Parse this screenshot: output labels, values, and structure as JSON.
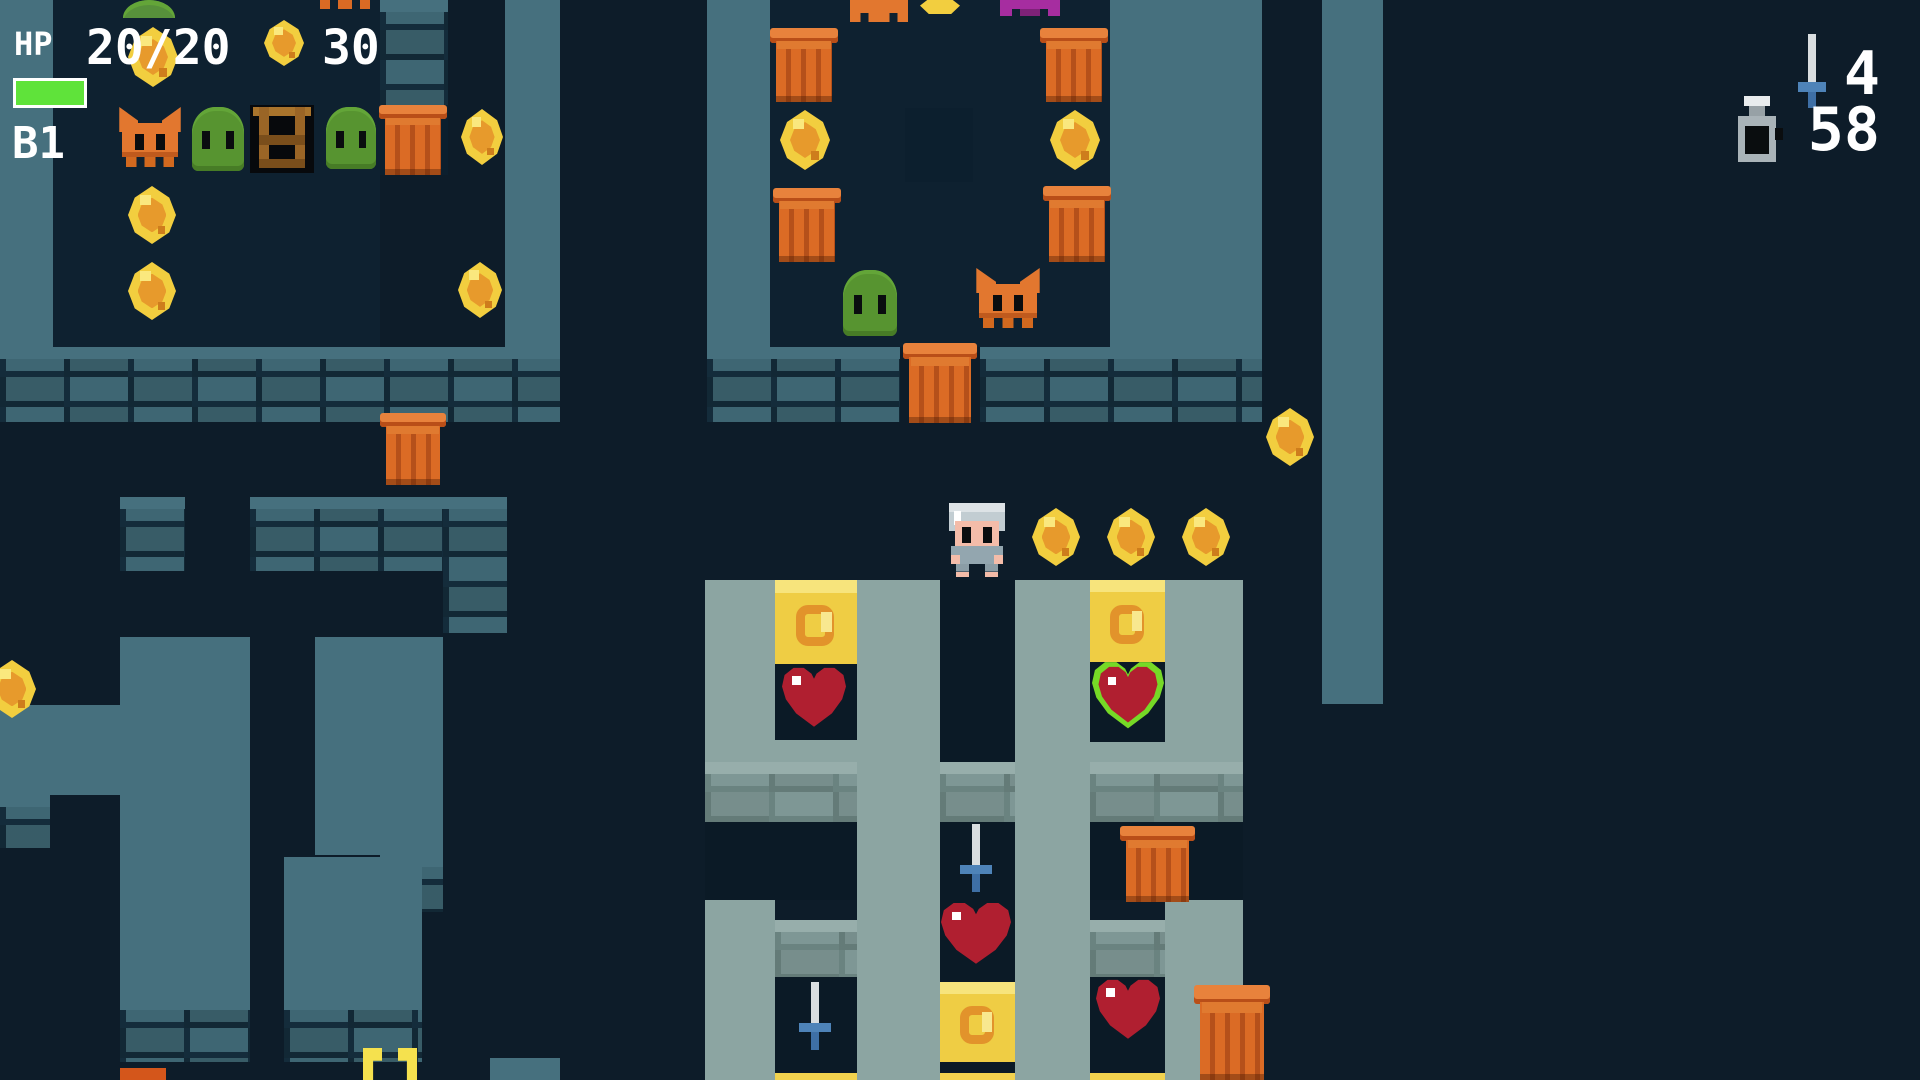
{
  "hud": {
    "hp_label": "HP",
    "hp_value": "20/20",
    "hp_percent": 100,
    "coin_count": "30",
    "floor": "B1",
    "sword_count": "4",
    "flask_count": "58",
    "icons": [
      "coin-icon",
      "sword-icon",
      "flask-icon"
    ]
  },
  "colors": {
    "background": "#0D1C29",
    "wall_teal": "#46707E",
    "wall_sage": "#8CA5A2",
    "hp_green": "#5FE33A",
    "coin_yellow": "#F2CE3F",
    "barrel_orange": "#DB6B25",
    "slime_green": "#579430",
    "bat_orange": "#E2772F",
    "heart_red": "#B01F30",
    "heart_ring_green": "#76D926",
    "sword_blue": "#4E83B8",
    "text": "#FFFFFF"
  },
  "map": {
    "walls": [
      {
        "x": 0,
        "y": 0,
        "w": 53,
        "h": 347,
        "s": "teal"
      },
      {
        "x": 380,
        "y": 0,
        "w": 68,
        "h": 105,
        "s": "tealb"
      },
      {
        "x": 505,
        "y": 0,
        "w": 55,
        "h": 347,
        "s": "teal"
      },
      {
        "x": 0,
        "y": 347,
        "w": 560,
        "h": 75,
        "s": "tealb"
      },
      {
        "x": 120,
        "y": 497,
        "w": 65,
        "h": 74,
        "s": "tealb"
      },
      {
        "x": 250,
        "y": 497,
        "w": 193,
        "h": 74,
        "s": "tealb"
      },
      {
        "x": 443,
        "y": 497,
        "w": 64,
        "h": 136,
        "s": "tealb"
      },
      {
        "x": 120,
        "y": 637,
        "w": 130,
        "h": 425,
        "s": "teal"
      },
      {
        "x": 120,
        "y": 998,
        "w": 130,
        "h": 64,
        "s": "tealb"
      },
      {
        "x": 0,
        "y": 705,
        "w": 120,
        "h": 90,
        "s": "teal"
      },
      {
        "x": 0,
        "y": 795,
        "w": 50,
        "h": 53,
        "s": "tealb"
      },
      {
        "x": 315,
        "y": 637,
        "w": 128,
        "h": 218,
        "s": "teal"
      },
      {
        "x": 380,
        "y": 855,
        "w": 63,
        "h": 57,
        "s": "tealb"
      },
      {
        "x": 284,
        "y": 857,
        "w": 138,
        "h": 141,
        "s": "teal"
      },
      {
        "x": 284,
        "y": 998,
        "w": 138,
        "h": 64,
        "s": "tealb"
      },
      {
        "x": 490,
        "y": 1058,
        "w": 70,
        "h": 22,
        "s": "teal"
      },
      {
        "x": 707,
        "y": 0,
        "w": 63,
        "h": 347,
        "s": "teal"
      },
      {
        "x": 1110,
        "y": 0,
        "w": 152,
        "h": 347,
        "s": "teal"
      },
      {
        "x": 707,
        "y": 347,
        "w": 193,
        "h": 75,
        "s": "tealb"
      },
      {
        "x": 980,
        "y": 347,
        "w": 282,
        "h": 75,
        "s": "tealb"
      },
      {
        "x": 840,
        "y": 20,
        "w": 200,
        "h": 182,
        "s": "tealL"
      },
      {
        "x": 840,
        "y": 202,
        "w": 200,
        "h": 61,
        "s": "tealLb"
      },
      {
        "x": 905,
        "y": 42,
        "w": 68,
        "h": 66,
        "s": "navyb"
      },
      {
        "x": 1322,
        "y": 0,
        "w": 61,
        "h": 704,
        "s": "teal"
      },
      {
        "x": 705,
        "y": 580,
        "w": 70,
        "h": 242,
        "s": "sage"
      },
      {
        "x": 705,
        "y": 900,
        "w": 70,
        "h": 180,
        "s": "sage"
      },
      {
        "x": 857,
        "y": 580,
        "w": 83,
        "h": 500,
        "s": "sage"
      },
      {
        "x": 1015,
        "y": 580,
        "w": 75,
        "h": 500,
        "s": "sage"
      },
      {
        "x": 1165,
        "y": 580,
        "w": 78,
        "h": 242,
        "s": "sage"
      },
      {
        "x": 1165,
        "y": 900,
        "w": 78,
        "h": 180,
        "s": "sage"
      },
      {
        "x": 775,
        "y": 740,
        "w": 82,
        "h": 22,
        "s": "sage"
      },
      {
        "x": 1090,
        "y": 742,
        "w": 75,
        "h": 20,
        "s": "sage"
      },
      {
        "x": 705,
        "y": 762,
        "w": 152,
        "h": 60,
        "s": "sageb"
      },
      {
        "x": 940,
        "y": 762,
        "w": 75,
        "h": 60,
        "s": "sageb"
      },
      {
        "x": 1090,
        "y": 762,
        "w": 153,
        "h": 60,
        "s": "sageb"
      },
      {
        "x": 775,
        "y": 920,
        "w": 82,
        "h": 57,
        "s": "sageb"
      },
      {
        "x": 1090,
        "y": 920,
        "w": 75,
        "h": 57,
        "s": "sageb"
      }
    ],
    "cells": [
      {
        "x": 53,
        "y": 0,
        "w": 327,
        "h": 347,
        "c": "#0E2130"
      },
      {
        "x": 770,
        "y": 0,
        "w": 340,
        "h": 347,
        "c": "#0E2130"
      },
      {
        "x": 905,
        "y": 108,
        "w": 68,
        "h": 74,
        "c": "#0C1F2E"
      },
      {
        "x": 380,
        "y": 105,
        "w": 68,
        "h": 70,
        "c": "#0C1F2E"
      },
      {
        "x": 775,
        "y": 662,
        "w": 82,
        "h": 78,
        "c": "#0B1A26"
      },
      {
        "x": 775,
        "y": 977,
        "w": 82,
        "h": 96,
        "c": "#0B1A26"
      },
      {
        "x": 940,
        "y": 580,
        "w": 75,
        "h": 182,
        "c": "#0B1A26"
      },
      {
        "x": 940,
        "y": 822,
        "w": 75,
        "h": 160,
        "c": "#0B1A26"
      },
      {
        "x": 940,
        "y": 1062,
        "w": 75,
        "h": 11,
        "c": "#0B1A26"
      },
      {
        "x": 1090,
        "y": 660,
        "w": 75,
        "h": 82,
        "c": "#0B1A26"
      },
      {
        "x": 1090,
        "y": 977,
        "w": 75,
        "h": 96,
        "c": "#0B1A26"
      },
      {
        "x": 705,
        "y": 822,
        "w": 152,
        "h": 78,
        "c": "#0B1A26"
      },
      {
        "x": 1090,
        "y": 822,
        "w": 153,
        "h": 78,
        "c": "#0B1A26"
      }
    ],
    "sprites": [
      {
        "t": "ytile",
        "x": 775,
        "y": 580,
        "w": 82,
        "h": 84
      },
      {
        "t": "ytile",
        "x": 1090,
        "y": 580,
        "w": 75,
        "h": 82
      },
      {
        "t": "ytile",
        "x": 940,
        "y": 982,
        "w": 75,
        "h": 80
      },
      {
        "t": "ysl",
        "x": 775,
        "y": 1073,
        "w": 82,
        "h": 10
      },
      {
        "t": "ysl",
        "x": 940,
        "y": 1073,
        "w": 75,
        "h": 10
      },
      {
        "t": "ysl",
        "x": 1090,
        "y": 1073,
        "w": 75,
        "h": 10
      },
      {
        "t": "coin",
        "x": 128,
        "y": 27,
        "w": 50,
        "h": 60
      },
      {
        "t": "coin",
        "x": 128,
        "y": 186,
        "w": 48,
        "h": 58
      },
      {
        "t": "coin",
        "x": 128,
        "y": 262,
        "w": 48,
        "h": 58
      },
      {
        "t": "coin",
        "x": 458,
        "y": 262,
        "w": 44,
        "h": 56
      },
      {
        "t": "coin",
        "x": 461,
        "y": 109,
        "w": 42,
        "h": 56
      },
      {
        "t": "coin",
        "x": 780,
        "y": 110,
        "w": 50,
        "h": 60
      },
      {
        "t": "coin",
        "x": 1050,
        "y": 110,
        "w": 50,
        "h": 60
      },
      {
        "t": "coin",
        "x": 1032,
        "y": 508,
        "w": 48,
        "h": 58
      },
      {
        "t": "coin",
        "x": 1107,
        "y": 508,
        "w": 48,
        "h": 58
      },
      {
        "t": "coin",
        "x": 1182,
        "y": 508,
        "w": 48,
        "h": 58
      },
      {
        "t": "coin",
        "x": 1266,
        "y": 408,
        "w": 48,
        "h": 58
      },
      {
        "t": "coin",
        "x": -12,
        "y": 660,
        "w": 48,
        "h": 58
      },
      {
        "t": "slime",
        "x": 192,
        "y": 107,
        "w": 52,
        "h": 64
      },
      {
        "t": "slime",
        "x": 326,
        "y": 107,
        "w": 50,
        "h": 62
      },
      {
        "t": "slime",
        "x": 843,
        "y": 270,
        "w": 54,
        "h": 66
      },
      {
        "t": "bat",
        "x": 118,
        "y": 107,
        "w": 64,
        "h": 60
      },
      {
        "t": "bat",
        "x": 975,
        "y": 268,
        "w": 66,
        "h": 60
      },
      {
        "t": "ladder",
        "x": 250,
        "y": 105,
        "w": 64,
        "h": 68
      },
      {
        "t": "barrel",
        "x": 381,
        "y": 105,
        "w": 64,
        "h": 70
      },
      {
        "t": "barrel",
        "x": 382,
        "y": 413,
        "w": 62,
        "h": 72
      },
      {
        "t": "barrel",
        "x": 772,
        "y": 28,
        "w": 64,
        "h": 74
      },
      {
        "t": "barrel",
        "x": 1042,
        "y": 28,
        "w": 64,
        "h": 74
      },
      {
        "t": "barrel",
        "x": 775,
        "y": 188,
        "w": 64,
        "h": 74
      },
      {
        "t": "barrel",
        "x": 1045,
        "y": 186,
        "w": 64,
        "h": 76
      },
      {
        "t": "barrel",
        "x": 905,
        "y": 343,
        "w": 70,
        "h": 80
      },
      {
        "t": "barrel",
        "x": 1122,
        "y": 826,
        "w": 71,
        "h": 76
      },
      {
        "t": "barrel",
        "x": 1196,
        "y": 985,
        "w": 72,
        "h": 95
      },
      {
        "t": "heart",
        "x": 782,
        "y": 666,
        "w": 64,
        "h": 64
      },
      {
        "t": "heart",
        "x": 941,
        "y": 901,
        "w": 70,
        "h": 66
      },
      {
        "t": "heart",
        "x": 1096,
        "y": 978,
        "w": 64,
        "h": 64
      },
      {
        "t": "heartg",
        "x": 1092,
        "y": 660,
        "w": 72,
        "h": 72
      },
      {
        "t": "sword",
        "x": 958,
        "y": 824,
        "w": 36,
        "h": 68
      },
      {
        "t": "sword",
        "x": 797,
        "y": 982,
        "w": 36,
        "h": 68
      },
      {
        "t": "player",
        "x": 945,
        "y": 503,
        "w": 64,
        "h": 74
      },
      {
        "t": "arc",
        "x": 123,
        "y": 0,
        "w": 52,
        "h": 18
      },
      {
        "t": "oslv",
        "x": 320,
        "y": 0,
        "w": 50,
        "h": 9
      },
      {
        "t": "batslv",
        "x": 850,
        "y": 0,
        "w": 58,
        "h": 22
      },
      {
        "t": "coinslv",
        "x": 920,
        "y": 0,
        "w": 40,
        "h": 14
      },
      {
        "t": "pslv",
        "x": 1000,
        "y": 0,
        "w": 60,
        "h": 16
      },
      {
        "t": "prongs",
        "x": 363,
        "y": 1048,
        "w": 54,
        "h": 32
      },
      {
        "t": "oslv2",
        "x": 120,
        "y": 1068,
        "w": 46,
        "h": 12
      }
    ]
  }
}
